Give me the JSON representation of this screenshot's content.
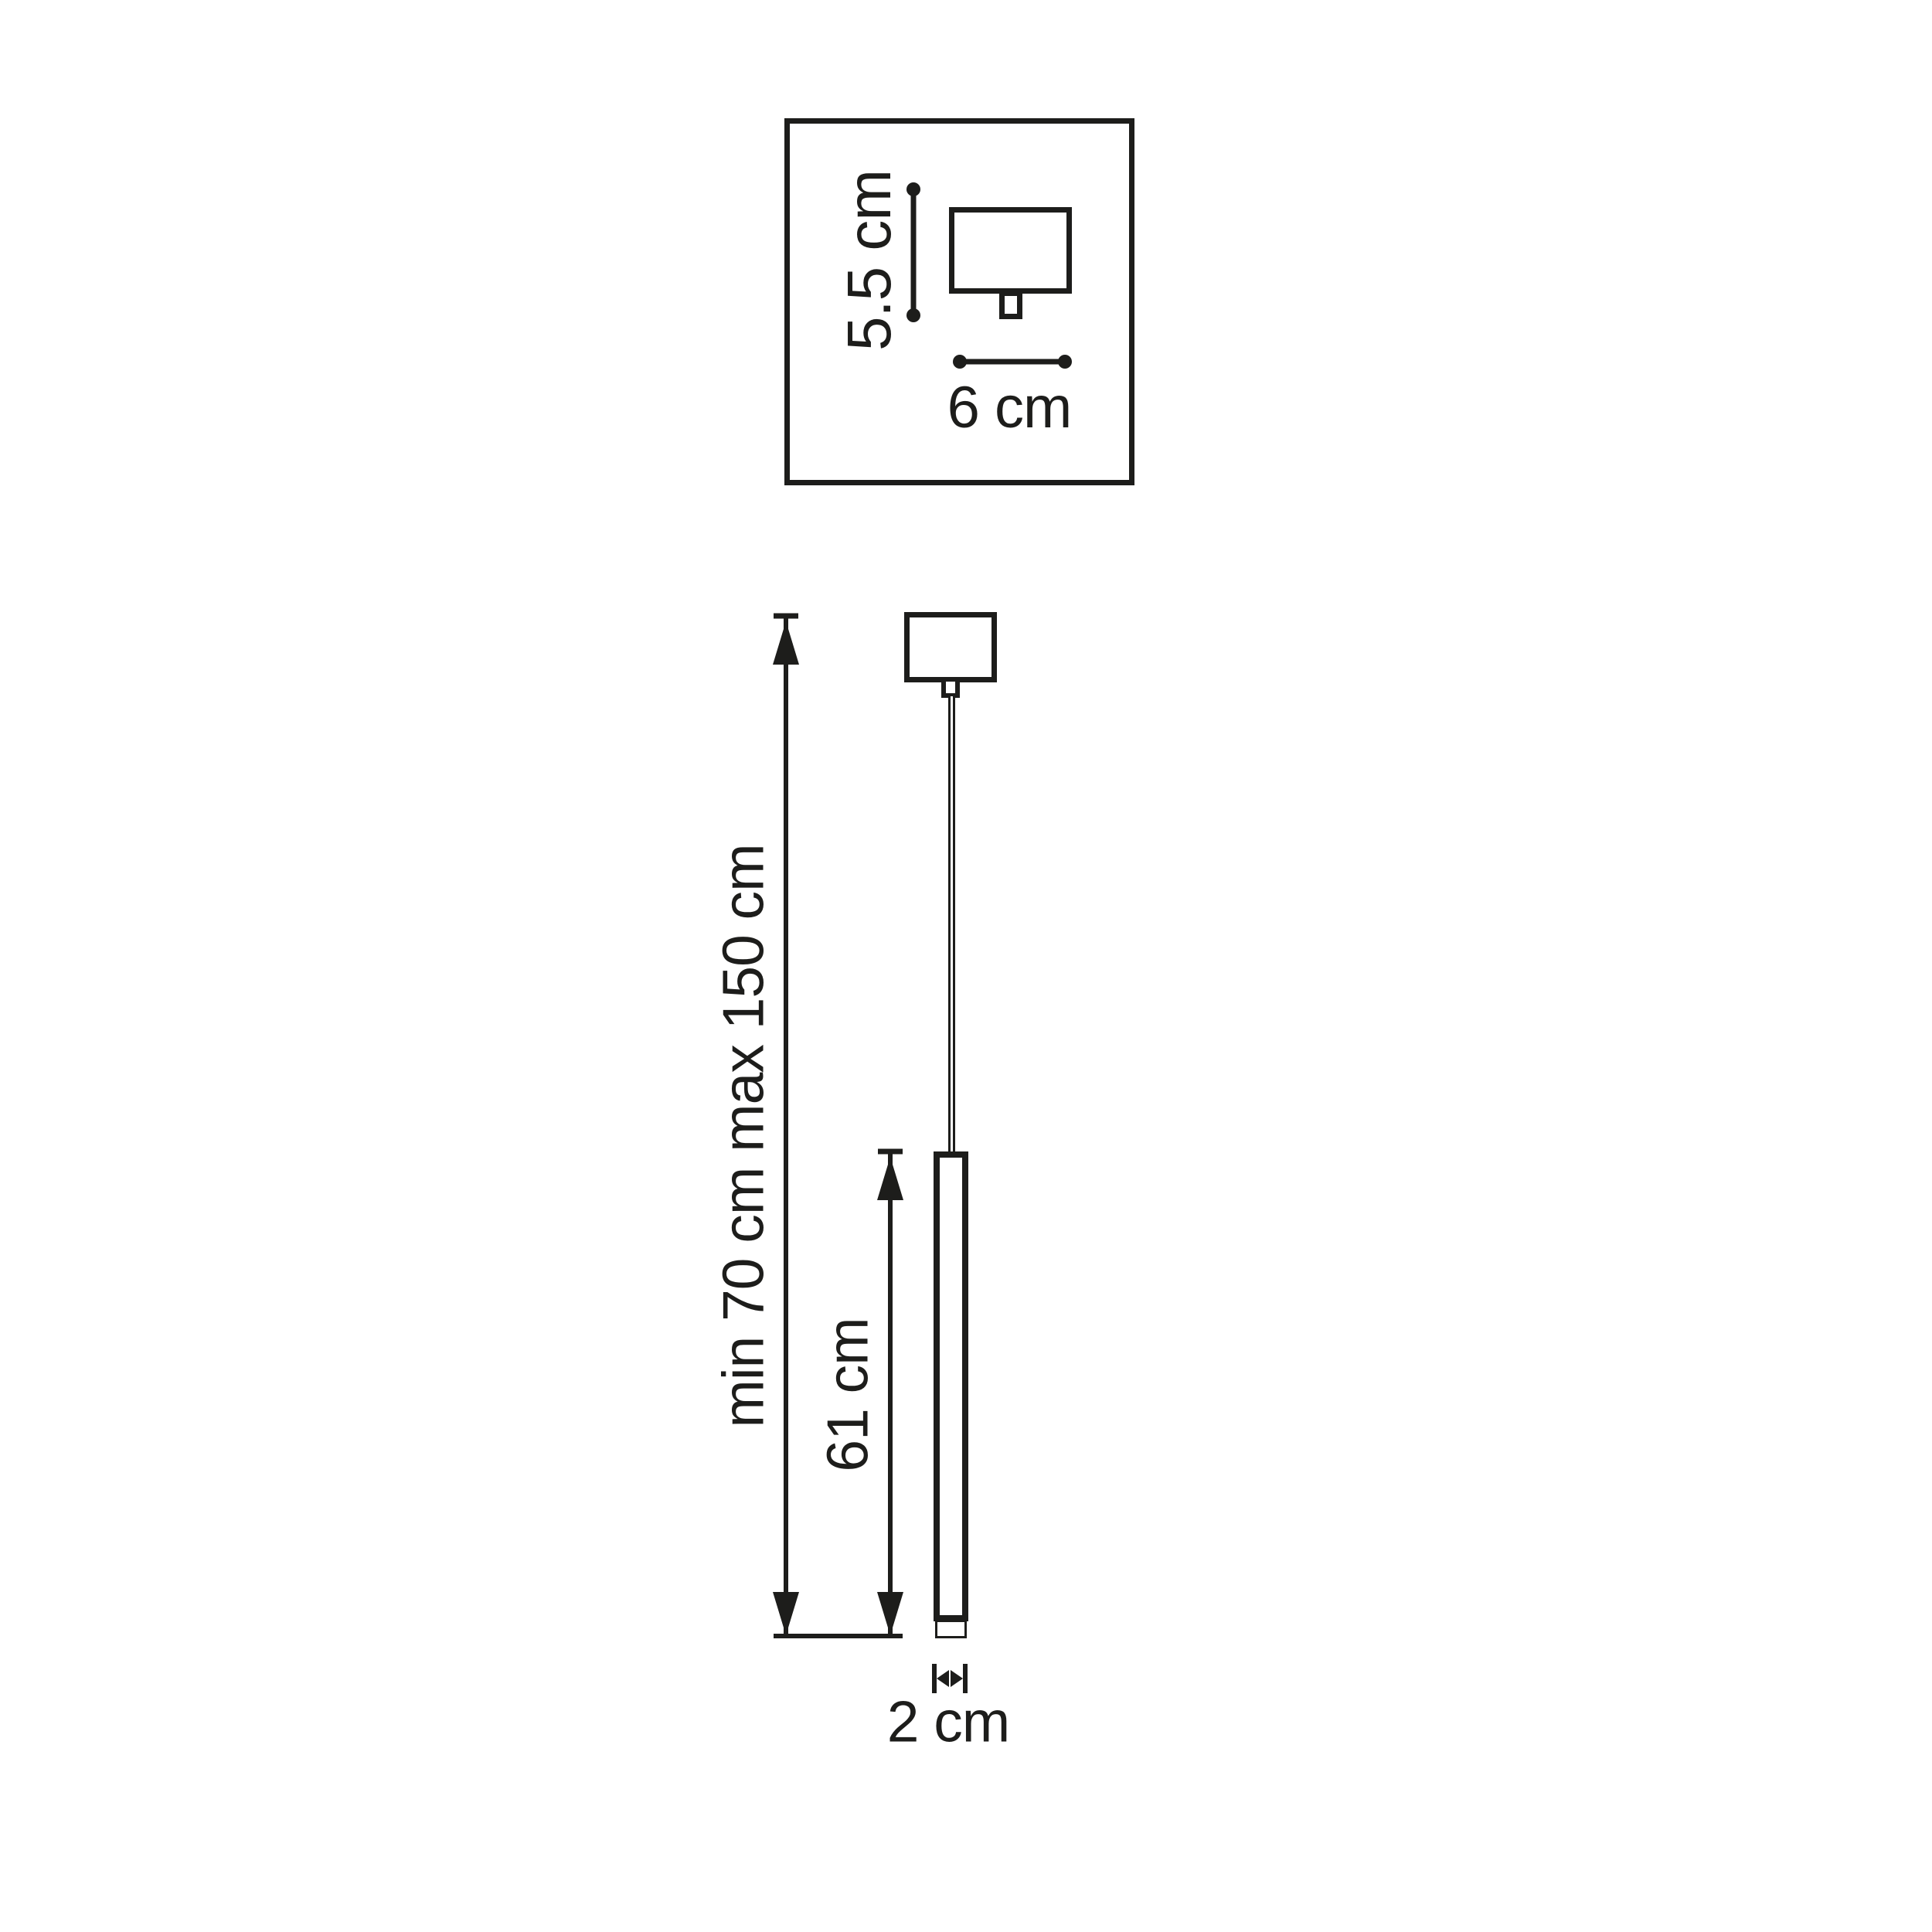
{
  "colors": {
    "ink": "#1d1d1b",
    "background": "#ffffff"
  },
  "top_detail_box": {
    "height_label": "5.5 cm",
    "width_label": "6 cm"
  },
  "pendant_view": {
    "overall_height_label": "min 70 cm max 150 cm",
    "fixture_height_label": "61 cm",
    "diameter_label": "2 cm"
  }
}
